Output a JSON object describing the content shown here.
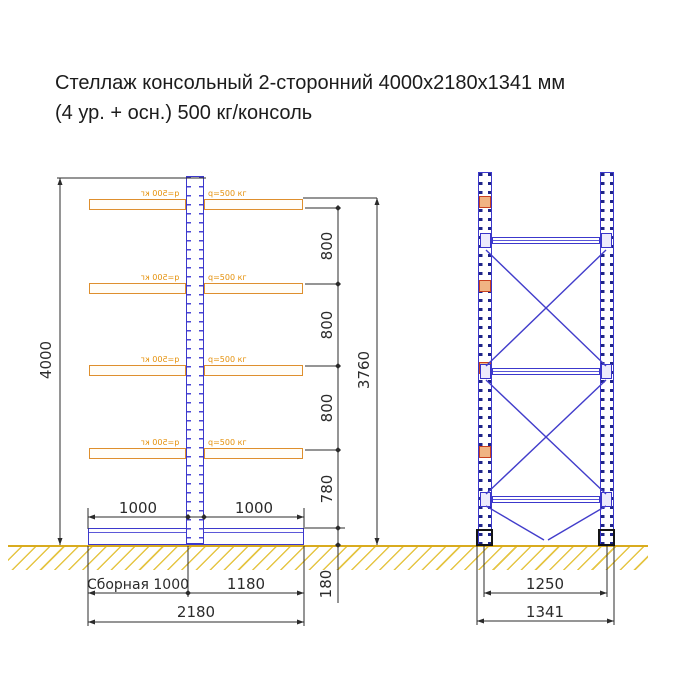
{
  "title": {
    "line1": "Стеллаж консольный 2-сторонний 4000х2180х1341 мм",
    "line2": "(4 ур. + осн.) 500 кг/консоль"
  },
  "side_view": {
    "height_label": "4000",
    "usable_height_label": "3760",
    "level_spacings": [
      "800",
      "800",
      "800",
      "780"
    ],
    "base_height_label": "180",
    "arm_left_label": "1000",
    "arm_right_label": "1000",
    "base_left_label": "Сборная 1000",
    "base_right_label": "1180",
    "total_depth_label": "2180",
    "console_load_label": "q=500 кг"
  },
  "front_view": {
    "axis_width_label": "1250",
    "total_width_label": "1341"
  },
  "colors": {
    "structure_blue": "#3c38cc",
    "console_orange": "#de8f2e",
    "load_label_orange": "#e5910c",
    "ground_yellow": "#e5c544",
    "dimension_black": "#2b2b2b"
  }
}
